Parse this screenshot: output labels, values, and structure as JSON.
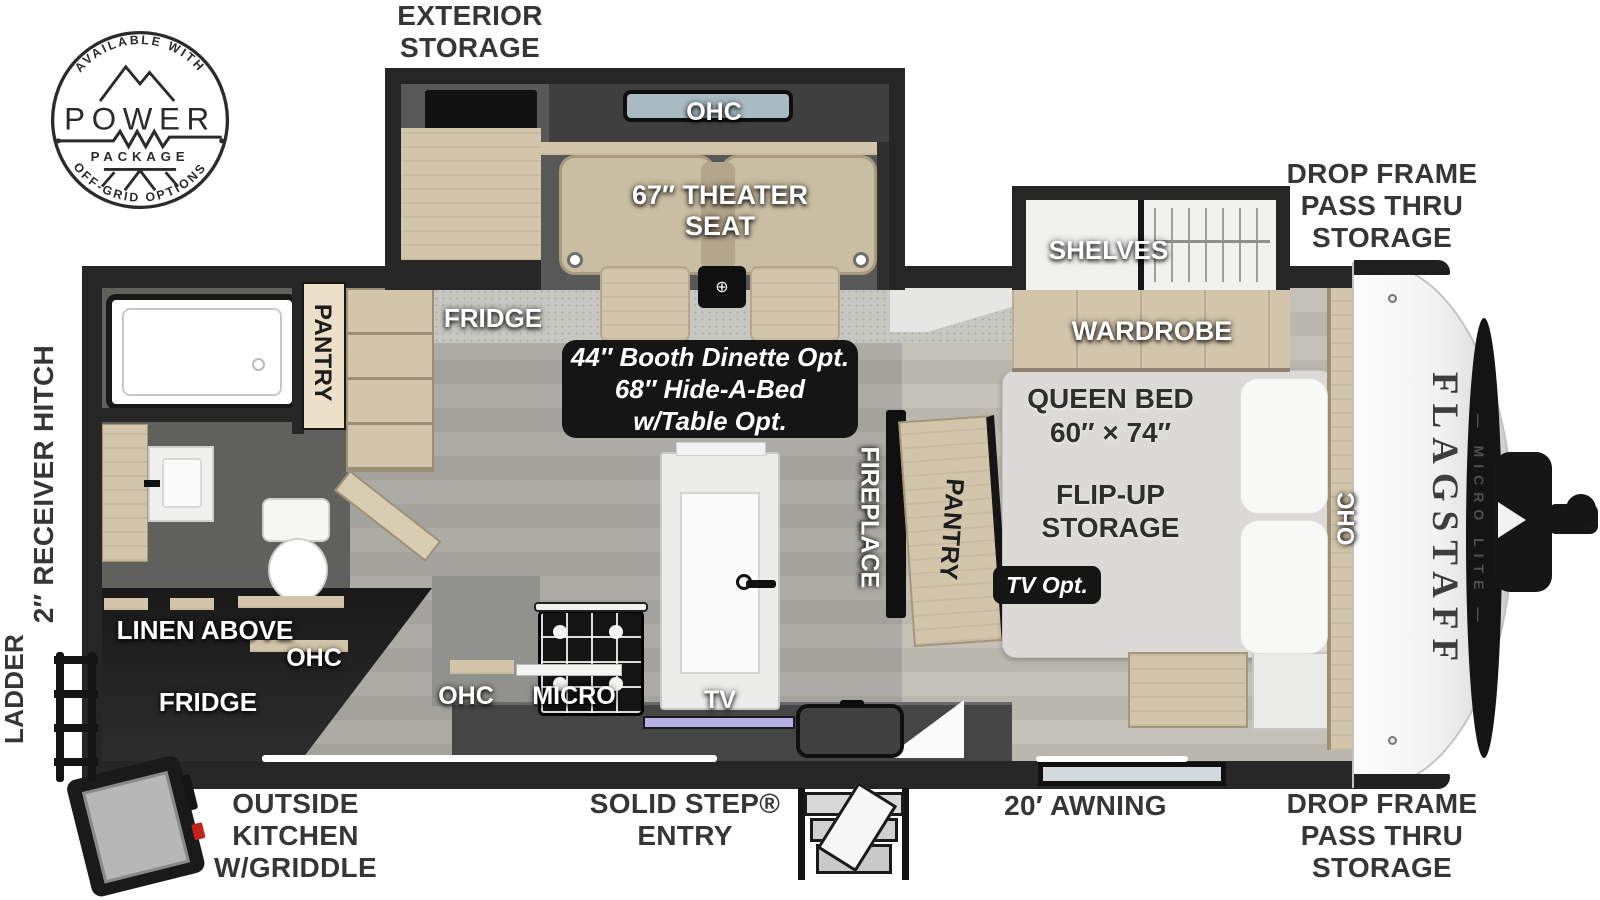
{
  "badge": {
    "top_arc": "AVAILABLE WITH",
    "title": "POWER",
    "subtitle": "PACKAGE",
    "bottom_arc": "OFF-GRID OPTIONS"
  },
  "brand": {
    "name": "FLAGSTAFF",
    "series": "— MICRO LITE —"
  },
  "exterior": {
    "exterior_storage": "EXTERIOR\nSTORAGE",
    "drop_frame_top": "DROP FRAME\nPASS THRU\nSTORAGE",
    "drop_frame_bottom": "DROP FRAME\nPASS THRU\nSTORAGE",
    "receiver_hitch": "2″ RECEIVER HITCH",
    "ladder": "LADDER",
    "outside_kitchen": "OUTSIDE KITCHEN\nW/GRIDDLE",
    "solid_step_entry": "SOLID STEP®\nENTRY",
    "awning": "20′ AWNING"
  },
  "interior": {
    "theater_ohc": "OHC",
    "theater_seat": "67″ THEATER\nSEAT",
    "slide_fridge": "FRIDGE",
    "dinette_option": "44″ Booth Dinette Opt.\n68″ Hide-A-Bed\nw/Table Opt.",
    "shelves": "SHELVES",
    "wardrobe": "WARDROBE",
    "queen_bed": "QUEEN BED",
    "queen_bed_size": "60″ × 74″",
    "flip_up_storage": "FLIP-UP\nSTORAGE",
    "tv_option": "TV Opt.",
    "fireplace": "FIREPLACE",
    "bedroom_pantry": "PANTRY",
    "bath_pantry": "PANTRY",
    "bedside_ohc": "OHC",
    "linen_above": "LINEN ABOVE",
    "rear_ohc": "OHC",
    "rear_fridge": "FRIDGE",
    "kitchen_ohc": "OHC",
    "kitchen_micro": "MICRO",
    "kitchen_tv": "TV"
  },
  "icons": {
    "cupholder_symbol": "⊕"
  },
  "colors": {
    "wall": "#262626",
    "floor_main": "#a8a7a1",
    "floor_bedroom": "#bfbcb4",
    "wood": "#d2c5aa",
    "label_dark": "#363636",
    "callout_bg": "#151515"
  }
}
